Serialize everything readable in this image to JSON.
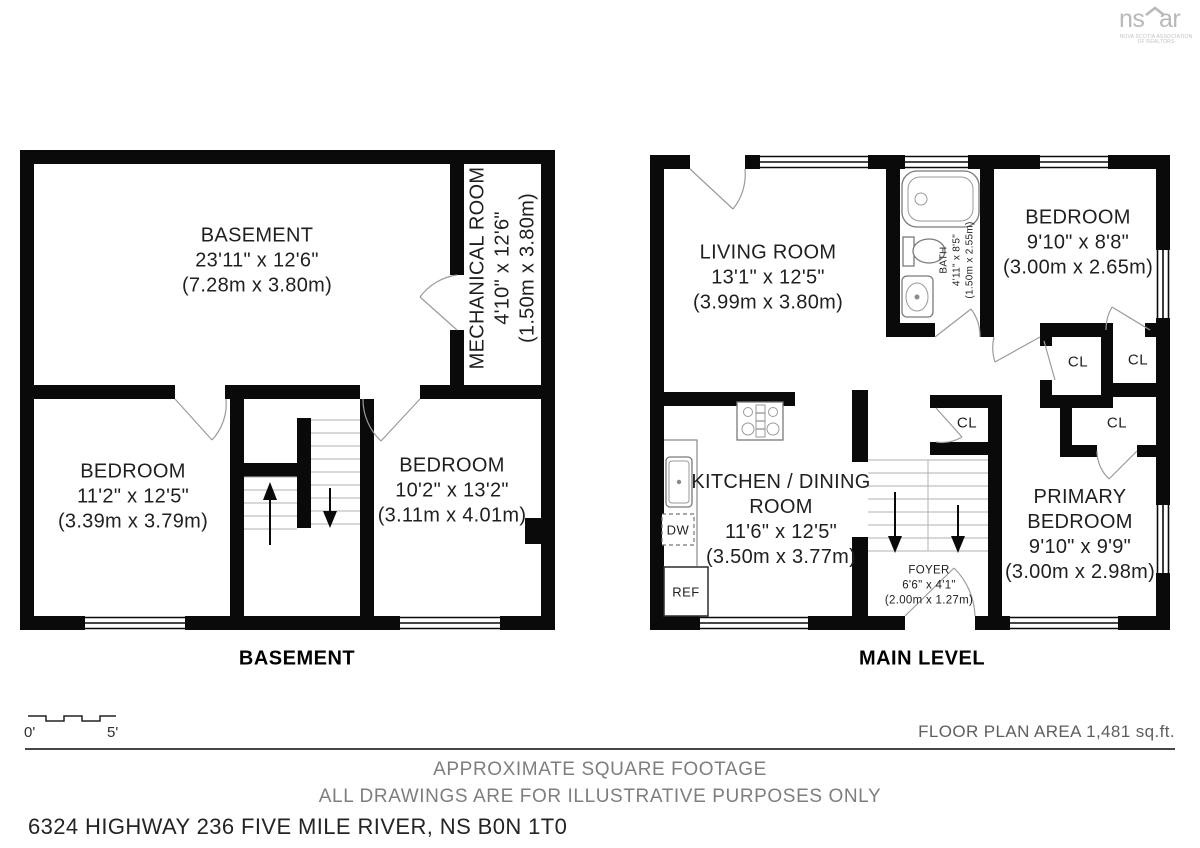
{
  "logo": {
    "part1": "ns",
    "part2": "ar",
    "tagline": "NOVA SCOTIA ASSOCIATION OF REALTORS"
  },
  "basement": {
    "label": "BASEMENT",
    "rooms": {
      "main": {
        "name": "BASEMENT",
        "dims": "23'11\" x 12'6\"",
        "metric": "(7.28m x 3.80m)"
      },
      "mechanical": {
        "name": "MECHANICAL ROOM",
        "dims": "4'10\" x 12'6\"",
        "metric": "(1.50m x 3.80m)"
      },
      "bedroom_left": {
        "name": "BEDROOM",
        "dims": "11'2\" x 12'5\"",
        "metric": "(3.39m x 3.79m)"
      },
      "bedroom_right": {
        "name": "BEDROOM",
        "dims": "10'2\" x 13'2\"",
        "metric": "(3.11m x 4.01m)"
      }
    }
  },
  "main_level": {
    "label": "MAIN LEVEL",
    "rooms": {
      "living": {
        "name": "LIVING ROOM",
        "dims": "13'1\" x 12'5\"",
        "metric": "(3.99m x 3.80m)"
      },
      "bath": {
        "name": "BATH",
        "dims": "4'11\" x 8'5\"",
        "metric": "(1.50m x 2.55m)"
      },
      "bedroom": {
        "name": "BEDROOM",
        "dims": "9'10\" x 8'8\"",
        "metric": "(3.00m x 2.65m)"
      },
      "kitchen": {
        "name_line1": "KITCHEN / DINING",
        "name_line2": "ROOM",
        "dims": "11'6\" x 12'5\"",
        "metric": "(3.50m x 3.77m)"
      },
      "foyer": {
        "name": "FOYER",
        "dims": "6'6\" x 4'1\"",
        "metric": "(2.00m x 1.27m)"
      },
      "primary": {
        "name_line1": "PRIMARY",
        "name_line2": "BEDROOM",
        "dims": "9'10\" x 9'9\"",
        "metric": "(3.00m x 2.98m)"
      }
    },
    "closets": {
      "cl1": "CL",
      "cl2": "CL",
      "cl3": "CL",
      "cl4": "CL"
    },
    "appliances": {
      "dw": "DW",
      "ref": "REF"
    }
  },
  "scale_bar": {
    "start": "0'",
    "end": "5'"
  },
  "footer": {
    "area": "FLOOR PLAN AREA 1,481 sq.ft.",
    "disclaimer1": "APPROXIMATE SQUARE FOOTAGE",
    "disclaimer2": "ALL DRAWINGS ARE FOR ILLUSTRATIVE PURPOSES ONLY",
    "address": "6324 HIGHWAY 236 FIVE MILE RIVER, NS B0N 1T0"
  }
}
